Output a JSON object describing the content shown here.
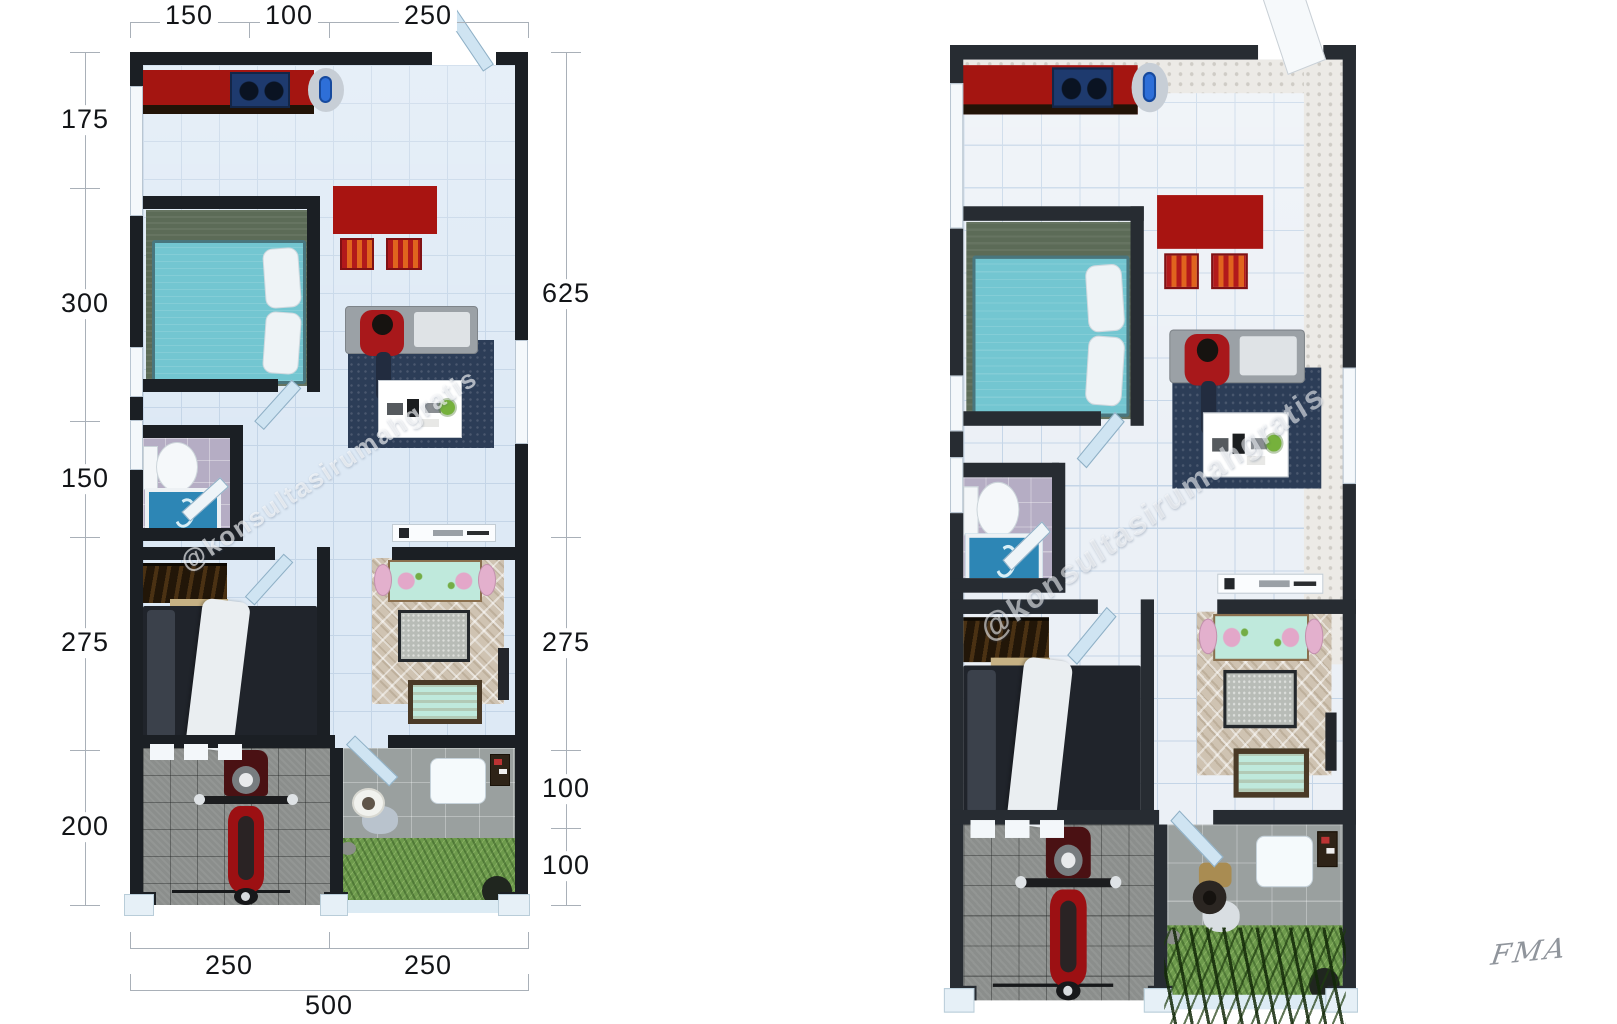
{
  "watermark": "@konsultasirumahgratis",
  "signature": "FMA",
  "left_plan": {
    "dim_top": [
      "150",
      "100",
      "250"
    ],
    "dim_left": [
      "175",
      "300",
      "150",
      "275",
      "200"
    ],
    "dim_right": [
      "625",
      "275",
      "100",
      "100"
    ],
    "dim_bottom": [
      "250",
      "250"
    ],
    "dim_total_width": "500"
  },
  "colors": {
    "wall": "#1b1f24",
    "floor_tile": "#dde9f5",
    "kitchen_counter": "#a41511",
    "stove": "#1e3a6e",
    "sink": "#2e6fd8",
    "dining_table": "#a81411",
    "bed_teal": "#73c6d1",
    "bed1_rug": "#5c6b57",
    "sofa": "#9ba1a6",
    "living_rug": "#2c3d57",
    "shirt": "#a8181b",
    "bathroom_floor": "#b5adc4",
    "tub": "#2d86b5",
    "wardrobe": "#221608",
    "bed2": "#20242b",
    "family_rug": "#cfc3b2",
    "family_table": "#bfe9dc",
    "chair_pink": "#e3b0cd",
    "bench": "#bfe9dc",
    "garage_floor": "#8b8e8c",
    "terrace_floor": "#9aa09f",
    "grass": "#6d9a4c",
    "motorcycle": "#9c1013",
    "door": "#cfe3f1"
  },
  "visible_elements": [
    "kitchen-counter",
    "gas-stove",
    "kitchen-sink",
    "red-dining-table",
    "striped-dining-chairs",
    "teal-double-bed",
    "white-pillows",
    "bedroom-rug",
    "sofa",
    "seated-person-red-shirt",
    "navy-living-rug",
    "white-coffee-table",
    "potted-plant",
    "toilet",
    "blue-bathtub",
    "console-shelf",
    "dark-wardrobe",
    "dark-bed-with-white-blanket",
    "mint-dining-set",
    "pink-chairs",
    "diamond-patterned-rug",
    "speckled-center-table",
    "mint-bench",
    "red-motorcycle",
    "paved-garage",
    "tiled-terrace",
    "garden-person",
    "garden-table",
    "grass-lawn",
    "swing-doors",
    "windows",
    "white-pillars",
    "bamboo-plants-right-plan"
  ]
}
